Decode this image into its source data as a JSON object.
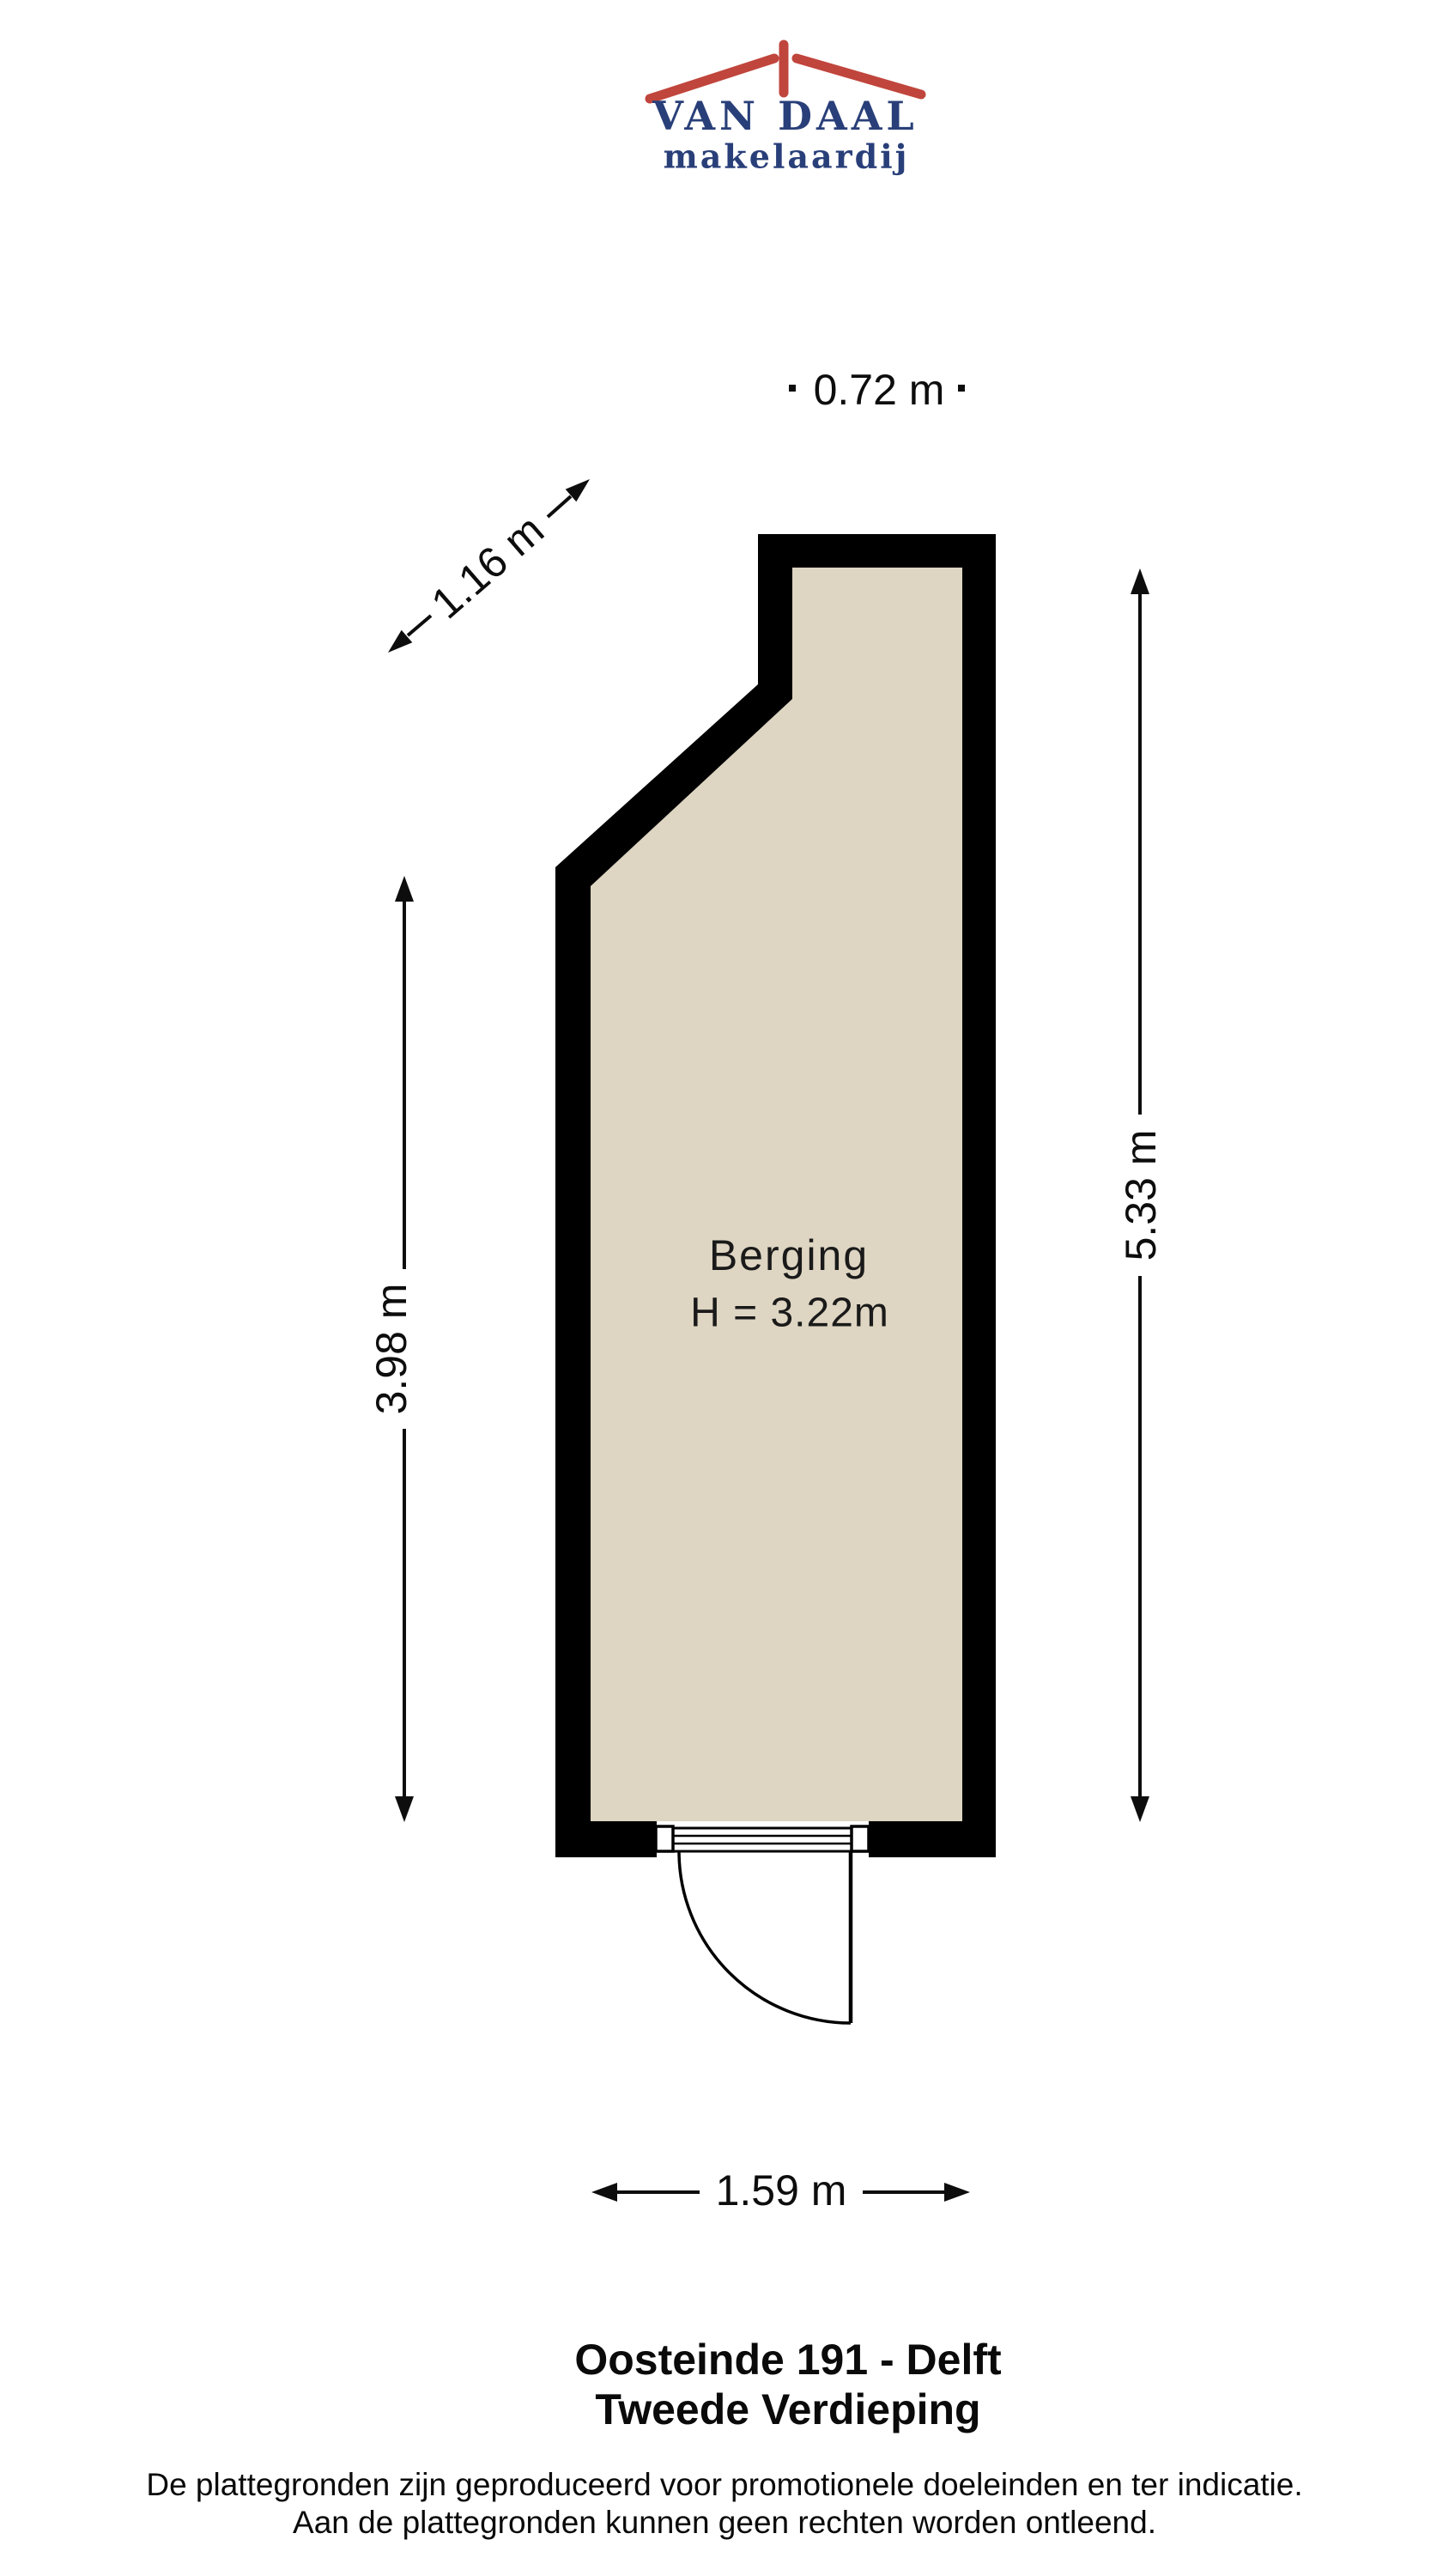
{
  "logo": {
    "name": "VAN DAAL",
    "subtitle": "makelaardij"
  },
  "plan": {
    "room": {
      "label": "Berging",
      "height_label": "H = 3.22m"
    },
    "dimensions": {
      "top": "0.72 m",
      "diagonal": "1.16 m",
      "left": "3.98 m",
      "right": "5.33 m",
      "bottom": "1.59 m"
    }
  },
  "footer": {
    "address": "Oosteinde 191 - Delft",
    "floor": "Tweede Verdieping",
    "disclaimer_line1": "De plattegronden zijn geproduceerd voor promotionele doeleinden en ter indicatie.",
    "disclaimer_line2": "Aan de plattegronden kunnen geen rechten worden ontleend."
  },
  "colors": {
    "wall": "#000000",
    "floor": "#ded5c2",
    "logo_navy": "#293f79",
    "logo_red": "#c0453c",
    "dimension_line": "#0d0d0d"
  }
}
